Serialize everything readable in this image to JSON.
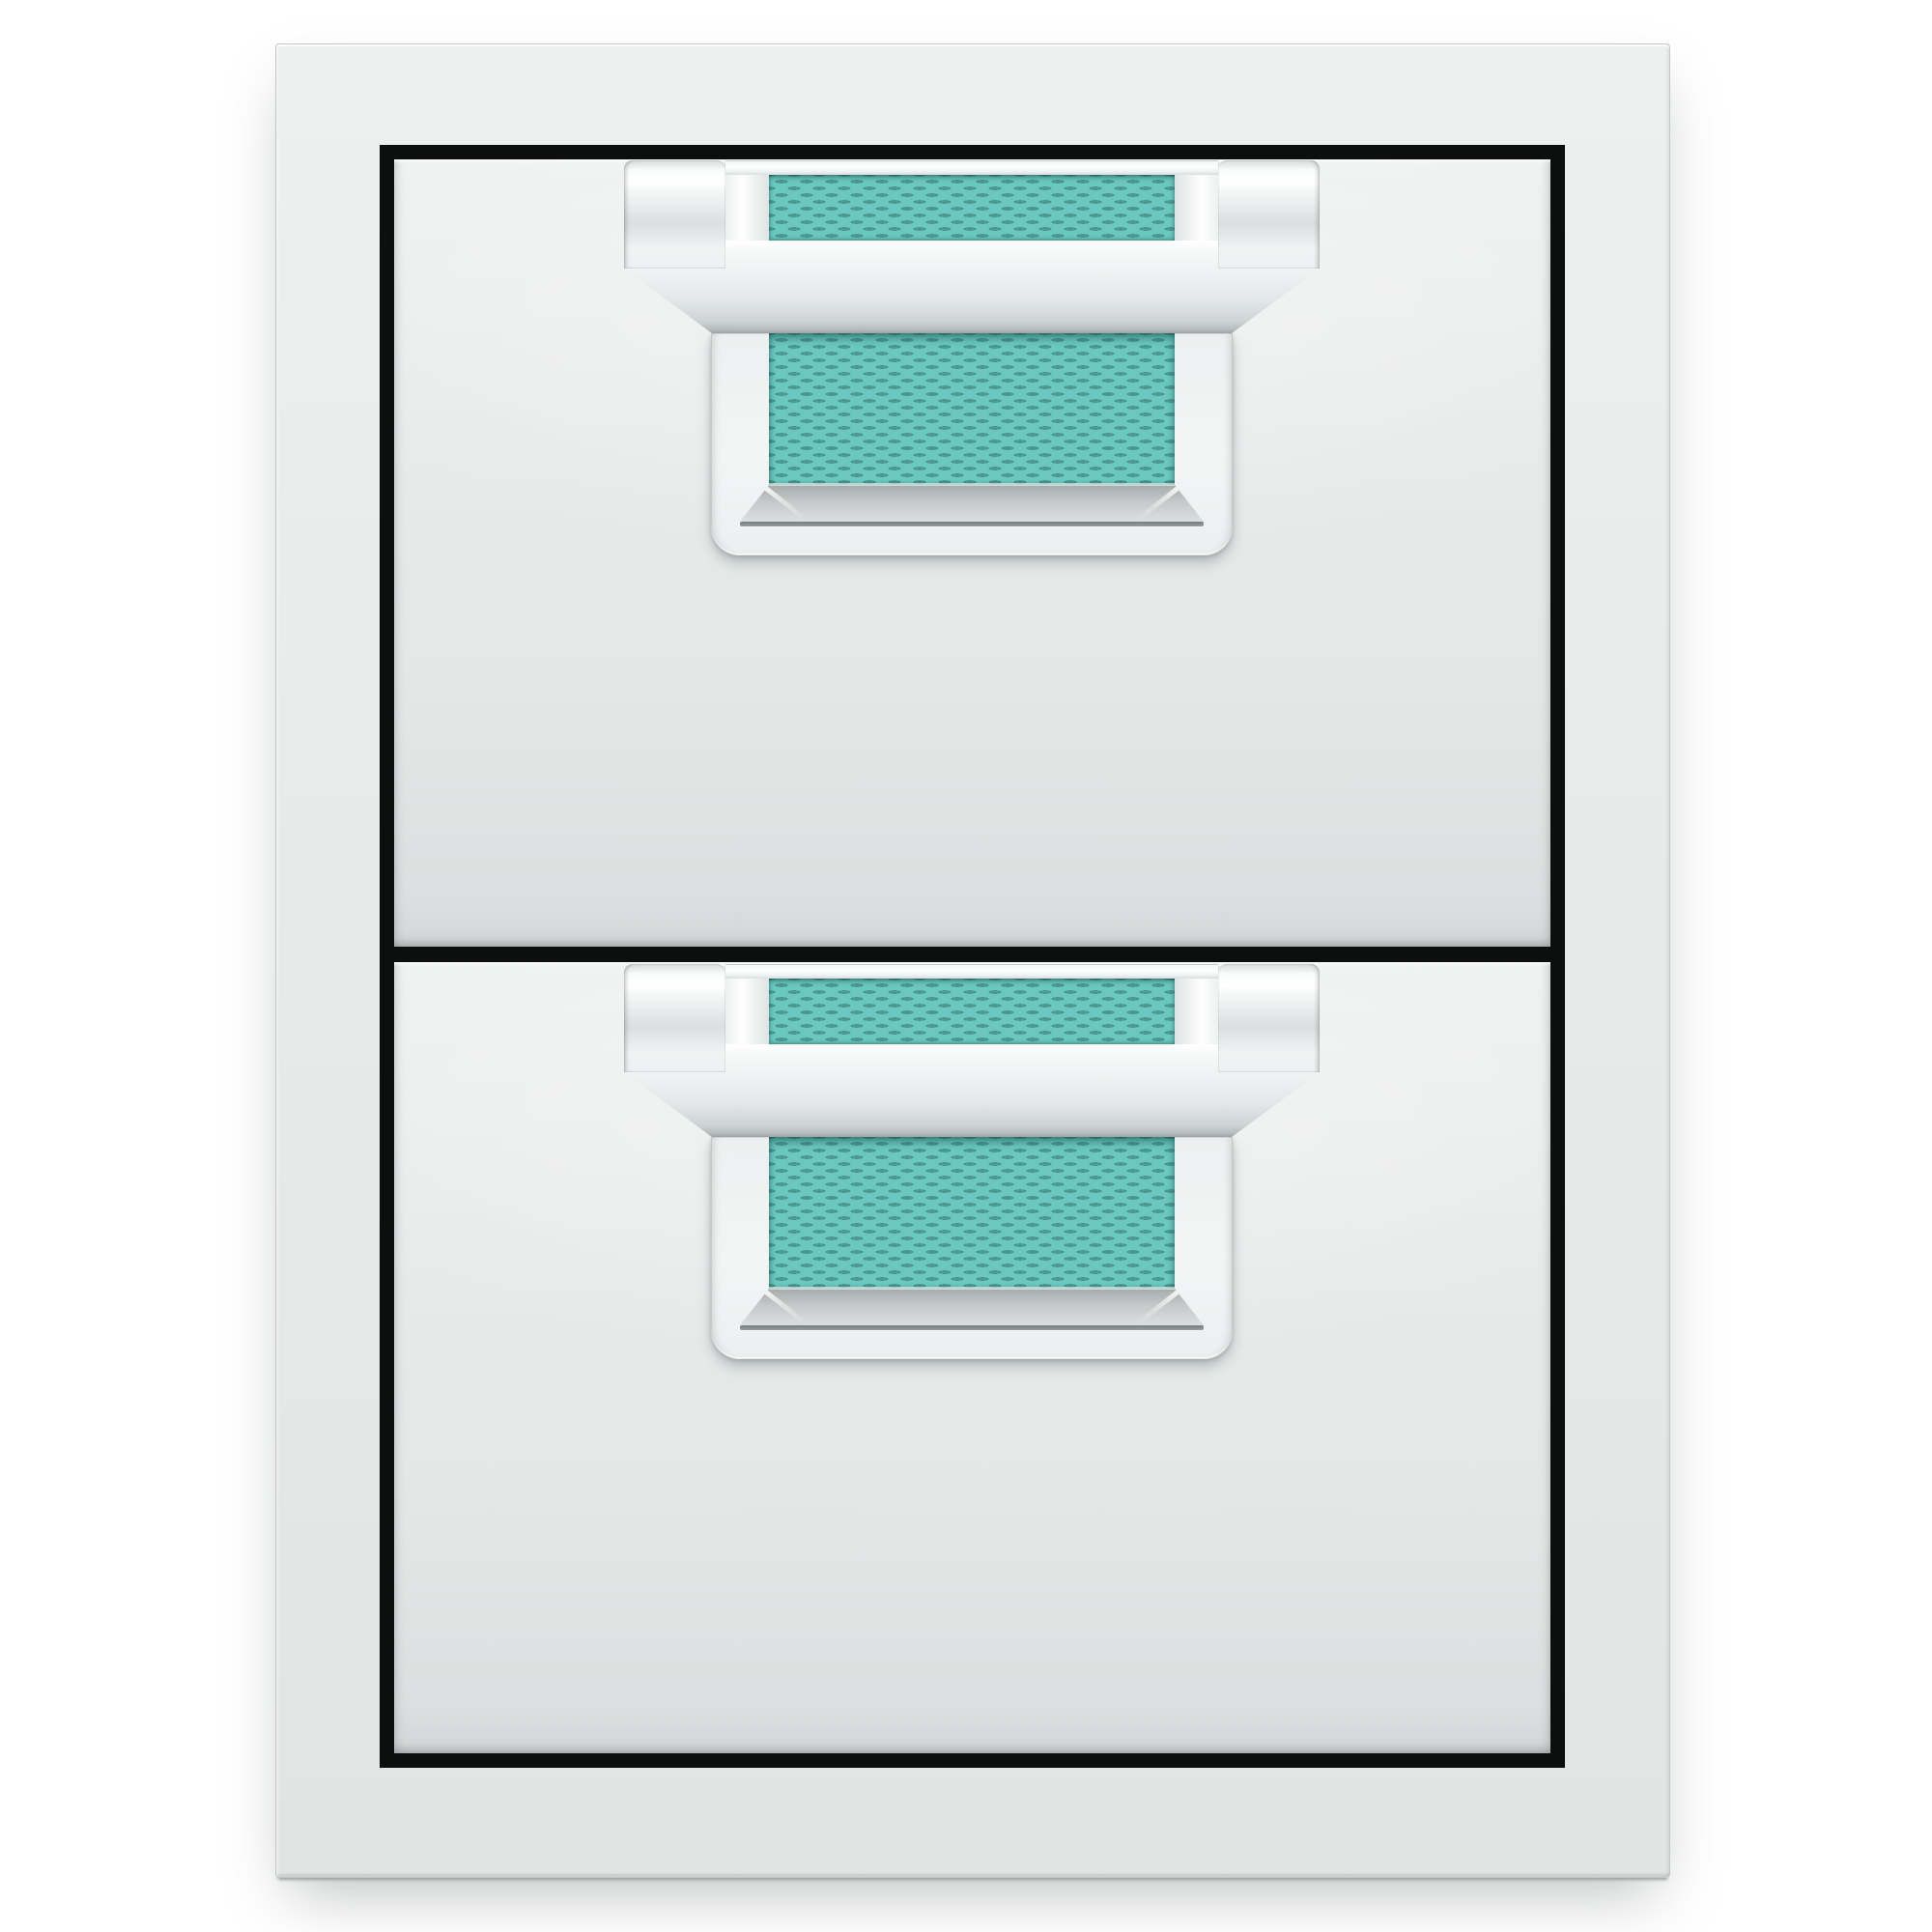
{
  "product": {
    "description": "Double storage drawer unit, stainless steel, with chrome pull handles and turquoise woven accent inserts",
    "drawer_count": 2
  },
  "colors": {
    "background": "#ffffff",
    "panel": "#e9ebeb",
    "groove": "#0d0f0f",
    "chrome_light": "#ffffff",
    "chrome_dark": "#c2c7c7",
    "accent": "#6bc8c0",
    "accent_dark": "#3f8d88",
    "sill_dark": "#a6abab"
  },
  "drawers": [
    {
      "id": "drawer-1",
      "label": "Top drawer",
      "handle_label": "Top drawer handle"
    },
    {
      "id": "drawer-2",
      "label": "Bottom drawer",
      "handle_label": "Bottom drawer handle"
    }
  ]
}
